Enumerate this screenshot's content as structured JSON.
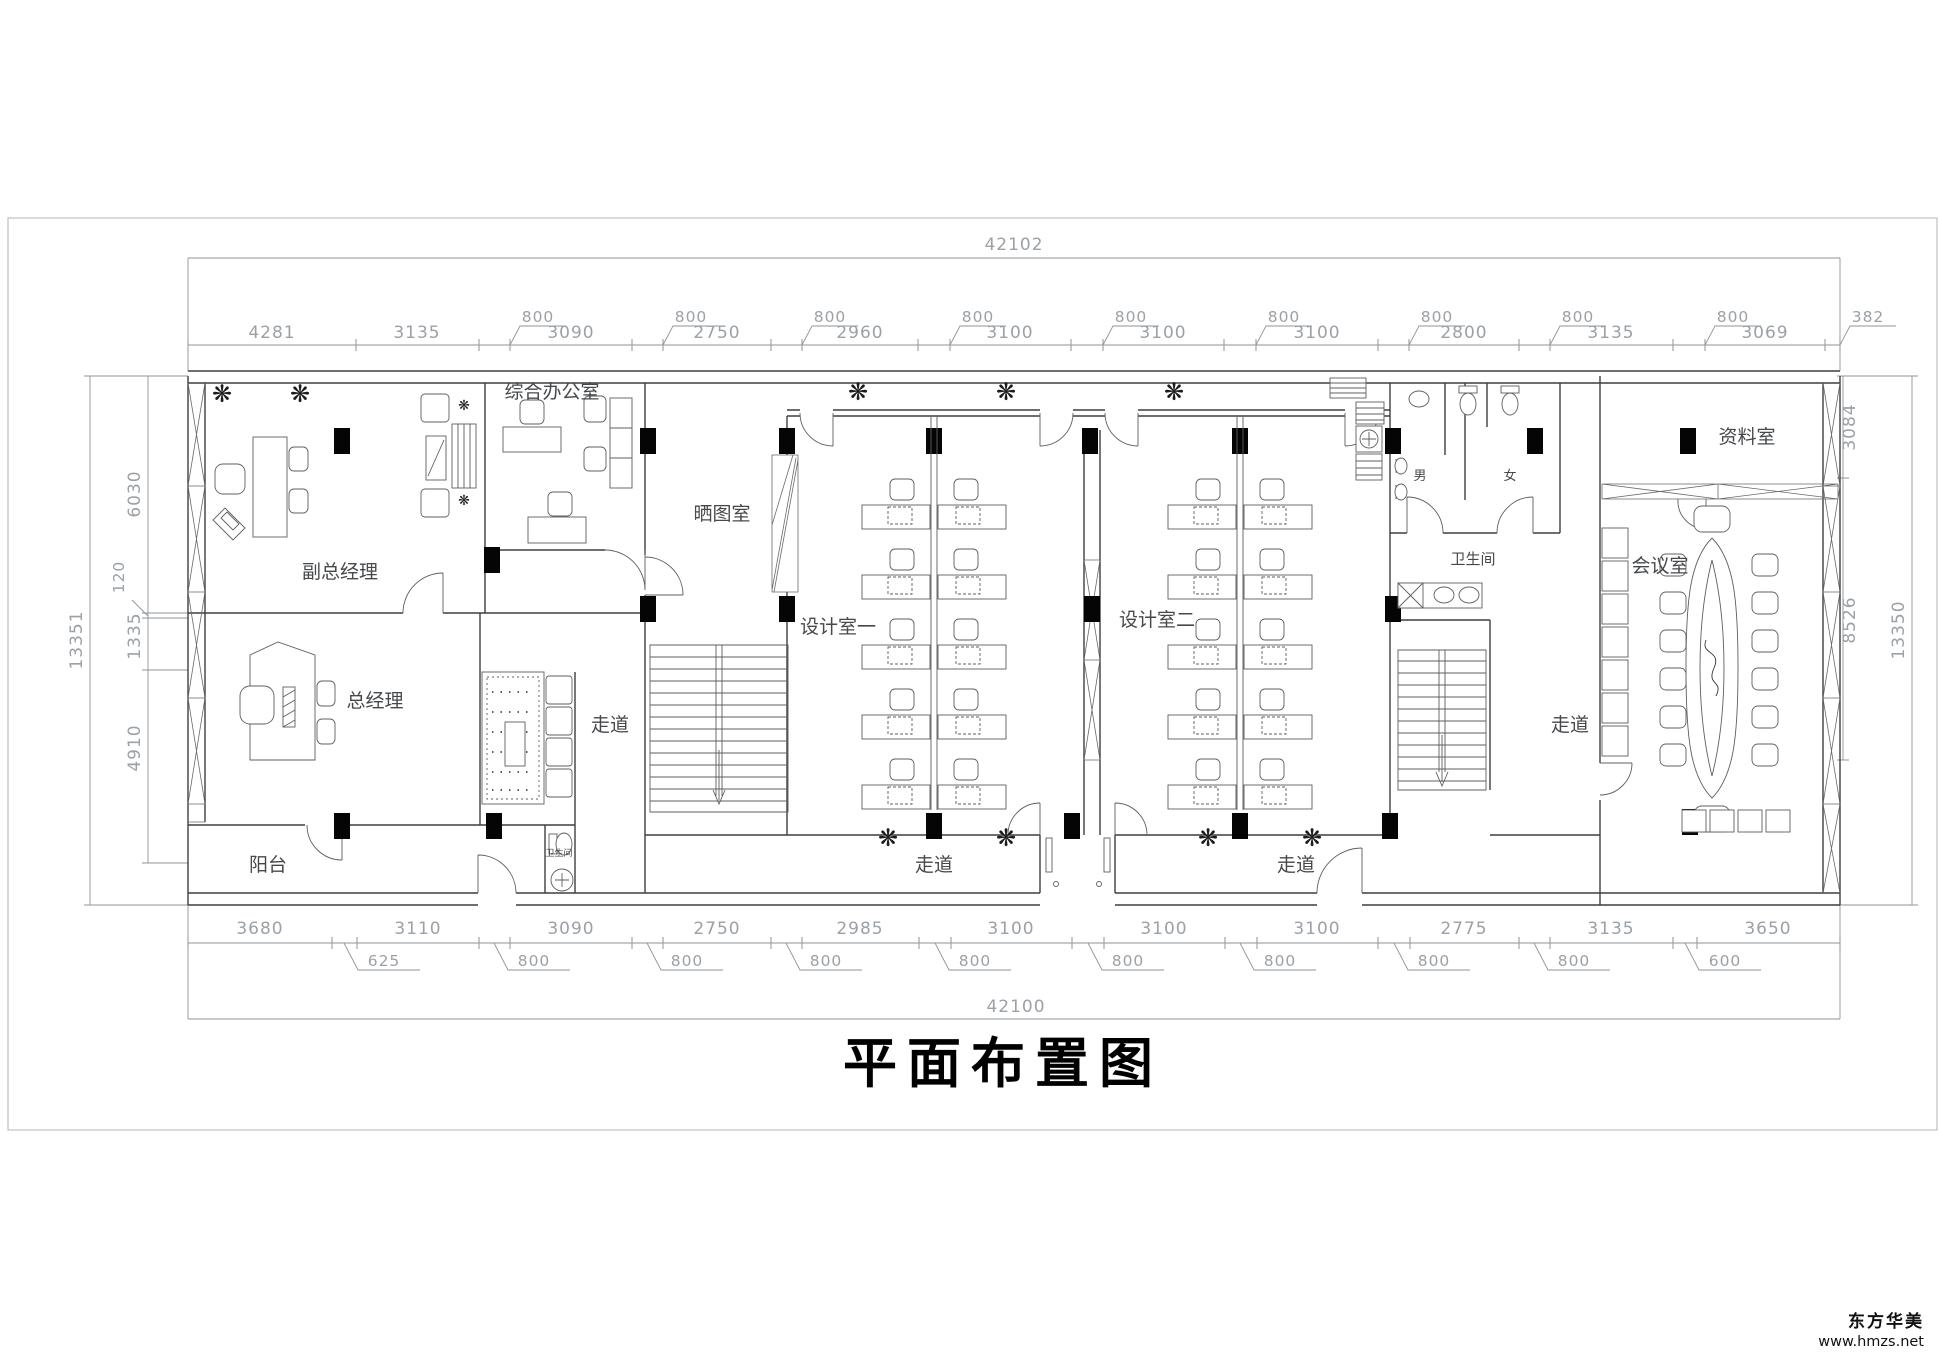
{
  "title": "平面布置图",
  "watermark": {
    "brand": "东方华美",
    "url": "www.hmzs.net"
  },
  "icons": {
    "plant": "❋"
  },
  "dims": {
    "top_total": "42102",
    "bottom_total": "42100",
    "top": [
      "4281",
      "3135",
      "800",
      "3090",
      "800",
      "2750",
      "800",
      "2960",
      "800",
      "3100",
      "800",
      "3100",
      "800",
      "3100",
      "800",
      "2800",
      "800",
      "3135",
      "800",
      "3069",
      "382"
    ],
    "bottom": [
      "3680",
      "3110",
      "3090",
      "2750",
      "2985",
      "3100",
      "3100",
      "3100",
      "2775",
      "3135",
      "3650"
    ],
    "bottom_leaders": [
      "625",
      "800",
      "800",
      "800",
      "800",
      "800",
      "800",
      "800",
      "800",
      "600"
    ],
    "left": {
      "total": "13351",
      "a": "6030",
      "b": "120",
      "c": "1335",
      "d": "4910"
    },
    "right": {
      "a": "3084",
      "b": "8526",
      "total": "13350"
    }
  },
  "rooms": {
    "deputy_gm": "副总经理",
    "general_office": "综合办公室",
    "blueprint_room": "晒图室",
    "design_room_1": "设计室一",
    "design_room_2": "设计室二",
    "archive_room": "资料室",
    "meeting_room": "会议室",
    "gm": "总经理",
    "balcony": "阳台",
    "restroom": "卫生间",
    "restroom_small": "卫生间",
    "male": "男",
    "female": "女",
    "corridor": "走道"
  }
}
